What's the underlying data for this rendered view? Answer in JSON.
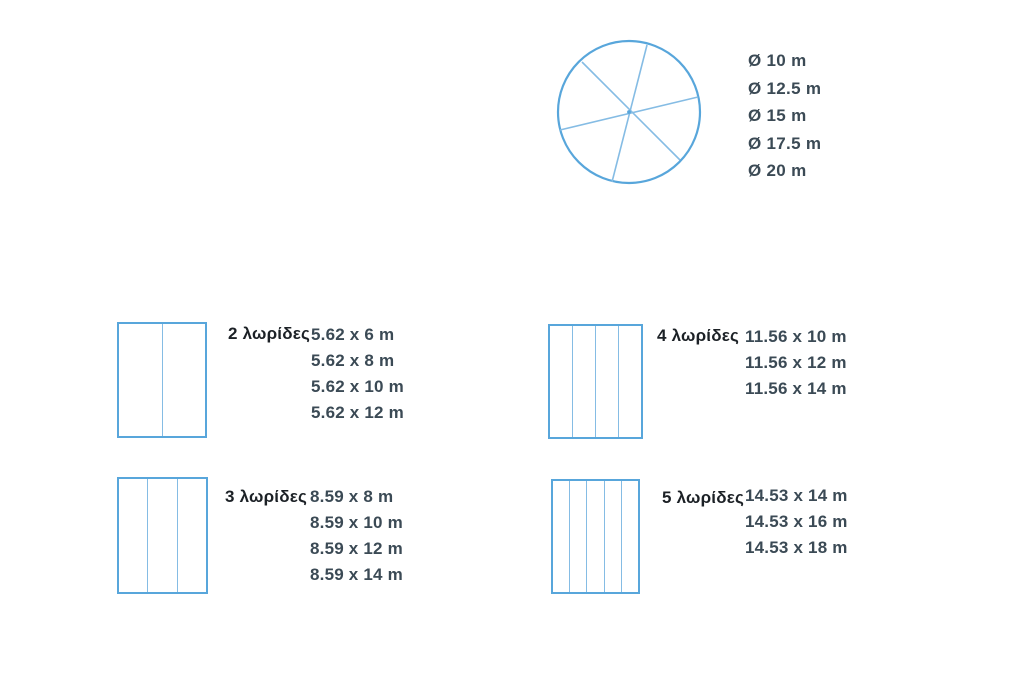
{
  "colors": {
    "shape_stroke": "#58a6db",
    "divider_stroke": "#85bce4",
    "label_text": "#1c2126",
    "value_text": "#3b4a55",
    "background": "#ffffff"
  },
  "circle_group": {
    "shape": "circle-with-3-crossing-chords",
    "diameters": [
      "Ø 10 m",
      "Ø 12.5 m",
      "Ø 15 m",
      "Ø 17.5 m",
      "Ø 20 m"
    ]
  },
  "strip_groups": [
    {
      "strips": 2,
      "label": "2 λωρίδες",
      "sizes": [
        "5.62 x 6 m",
        "5.62 x 8 m",
        "5.62 x 10 m",
        "5.62 x 12 m"
      ]
    },
    {
      "strips": 3,
      "label": "3 λωρίδες",
      "sizes": [
        "8.59 x 8 m",
        "8.59 x 10 m",
        "8.59 x 12 m",
        "8.59 x 14 m"
      ]
    },
    {
      "strips": 4,
      "label": "4 λωρίδες",
      "sizes": [
        "11.56 x 10 m",
        "11.56 x 12 m",
        "11.56 x 14 m"
      ]
    },
    {
      "strips": 5,
      "label": "5 λωρίδες",
      "sizes": [
        "14.53 x 14 m",
        "14.53 x 16 m",
        "14.53 x 18 m"
      ]
    }
  ]
}
